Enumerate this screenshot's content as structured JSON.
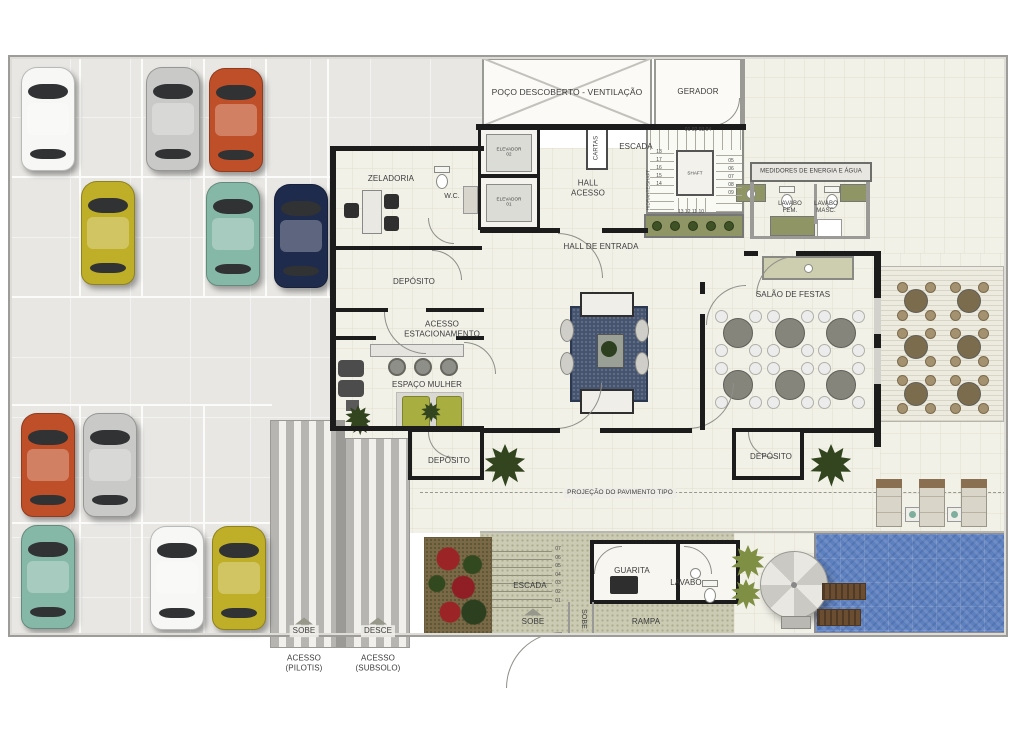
{
  "labels": {
    "poco": "POÇO DESCOBERTO - VENTILAÇÃO",
    "gerador": "GERADOR",
    "elevador02": "ELEVADOR\n02",
    "elevador01": "ELEVADOR\n01",
    "cartas": "CARTAS",
    "escadaTop": "ESCADA",
    "shaft": "SHAFT",
    "hidrante": "HIDRANTE/SHAFT",
    "zeladoria": "ZELADORIA",
    "wc": "W.C.",
    "medidores": "MEDIDORES DE ENERGIA E ÁGUA",
    "lavaboFem": "LAVABO\nFEM.",
    "lavaboMasc": "LAVABO\nMASC.",
    "hallAcesso": "HALL\nACESSO",
    "hallEntrada": "HALL DE ENTRADA",
    "depositoUL": "DEPÓSITO",
    "acessoEstacionamento": "ACESSO\nESTACIONAMENTO",
    "espacoMulher": "ESPAÇO MULHER",
    "depositoLL": "DEPÓSITO",
    "depositoLR": "DEPÓSITO",
    "salaoFestas": "SALÃO DE FESTAS",
    "projecao": "PROJEÇÃO DO PAVIMENTO TIPO",
    "escadaBottom": "ESCADA",
    "sobeEscada": "SOBE",
    "sobeRampa": "SOBE",
    "guarita": "GUARITA",
    "lavabo": "LAVABO",
    "rampa": "RAMPA",
    "sobeLeft": "SOBE",
    "desce": "DESCE",
    "acessoPilotis": "ACESSO\n(PILOTIS)",
    "acessoSubsolo": "ACESSO\n(SUBSOLO)"
  },
  "stairs": {
    "top": {
      "topRow": "01 02 03 04",
      "left": [
        "18",
        "17",
        "16",
        "15",
        "14"
      ],
      "right": [
        "05",
        "06",
        "07",
        "08",
        "09"
      ],
      "bottomRow": "13 12 11 10"
    },
    "bottom": [
      "07",
      "06",
      "05",
      "04",
      "03",
      "02",
      "01"
    ]
  },
  "cars": [
    {
      "id": "car-white-1",
      "color": "#f7f7f5"
    },
    {
      "id": "car-silver-1",
      "color": "#c9c9c7"
    },
    {
      "id": "car-orange-1",
      "color": "#bf4f28"
    },
    {
      "id": "car-yellow-1",
      "color": "#bfae28"
    },
    {
      "id": "car-teal-1",
      "color": "#86b8a7"
    },
    {
      "id": "car-navy-1",
      "color": "#1f2b4d"
    },
    {
      "id": "car-orange-2",
      "color": "#bf4f28"
    },
    {
      "id": "car-silver-2",
      "color": "#c9c9c7"
    },
    {
      "id": "car-teal-2",
      "color": "#86b8a7"
    },
    {
      "id": "car-white-2",
      "color": "#f7f7f5"
    },
    {
      "id": "car-yellow-2",
      "color": "#bfae28"
    }
  ],
  "palette": {
    "wall": "#1c1c1c",
    "parking_floor": "#e8e7e4",
    "interior_floor": "#f2f1e8",
    "walkway_green": "#cbcbb3",
    "planter_green": "#8f9565",
    "sofa_green": "#a8ae3f",
    "rug_blue": "#45536e",
    "pool_blue": "#5d80bf"
  },
  "furniture_counts": {
    "parked_cars": 11,
    "salao_tables": 6,
    "terrace_tables": 6,
    "pool_loungers": 2,
    "deck_loungers": 3,
    "salon_chairs": 3
  }
}
